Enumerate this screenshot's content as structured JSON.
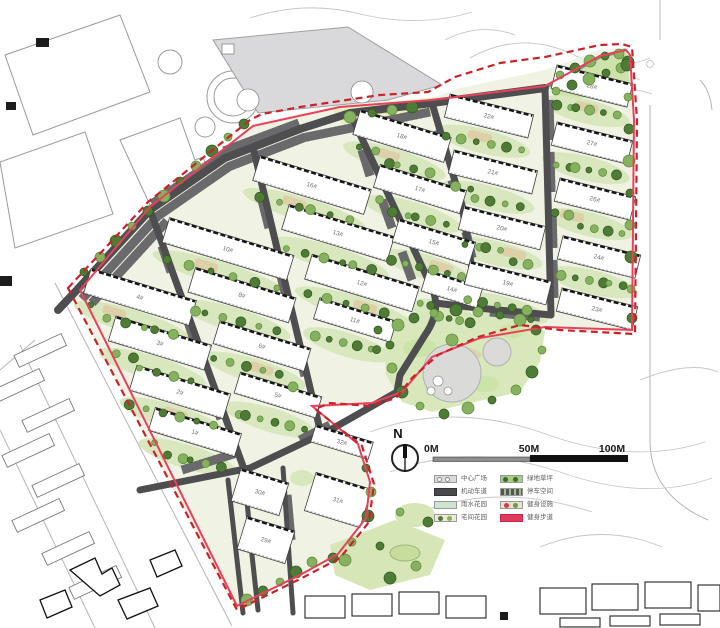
{
  "north_arrow": {
    "label": "N"
  },
  "scale_bar": {
    "labels": [
      "0M",
      "50M",
      "100M"
    ]
  },
  "legend": {
    "items": [
      {
        "label": "中心广场",
        "type": "plaza"
      },
      {
        "label": "机动车道",
        "type": "road"
      },
      {
        "label": "雨水花园",
        "type": "rain"
      },
      {
        "label": "宅间花园",
        "type": "courtyard"
      },
      {
        "label": "绿地草坪",
        "type": "lawn"
      },
      {
        "label": "停车空间",
        "type": "parking"
      },
      {
        "label": "健身设施",
        "type": "fitness"
      },
      {
        "label": "健身步道",
        "type": "trail"
      }
    ]
  },
  "map": {
    "colors": {
      "boundary": "#c8232b",
      "trail": "#e8415c",
      "road": "#4e4e50",
      "road_minor": "#87878a",
      "parking_base": "#6a6a6c",
      "parking_tick": "#a9c78e",
      "garden": "#d8e7bd",
      "lawn": "#cde4a9",
      "park": "#d8e8ba",
      "tree_dark": "#4e7c36",
      "tree_light": "#86b15e",
      "tan_path": "#dfcaa6",
      "site_base": "#f0f3e4",
      "plaza_gray": "#dadad8",
      "parking_lot_gray": "#d9d9db"
    },
    "buildings": [
      {
        "label": "4#",
        "cx": 140,
        "cy": 297,
        "w": 110,
        "h": 26,
        "angle": 17
      },
      {
        "label": "3#",
        "cx": 160,
        "cy": 343,
        "w": 100,
        "h": 26,
        "angle": 17
      },
      {
        "label": "2#",
        "cx": 180,
        "cy": 392,
        "w": 98,
        "h": 26,
        "angle": 17
      },
      {
        "label": "1#",
        "cx": 195,
        "cy": 432,
        "w": 90,
        "h": 24,
        "angle": 17
      },
      {
        "label": "10#",
        "cx": 228,
        "cy": 249,
        "w": 130,
        "h": 26,
        "angle": 17
      },
      {
        "label": "8#",
        "cx": 242,
        "cy": 295,
        "w": 105,
        "h": 26,
        "angle": 17
      },
      {
        "label": "6#",
        "cx": 262,
        "cy": 346,
        "w": 95,
        "h": 24,
        "angle": 17
      },
      {
        "label": "5#",
        "cx": 278,
        "cy": 395,
        "w": 85,
        "h": 22,
        "angle": 17
      },
      {
        "label": "16#",
        "cx": 312,
        "cy": 185,
        "w": 116,
        "h": 26,
        "angle": 17
      },
      {
        "label": "13#",
        "cx": 338,
        "cy": 233,
        "w": 110,
        "h": 26,
        "angle": 17
      },
      {
        "label": "12#",
        "cx": 362,
        "cy": 283,
        "w": 112,
        "h": 26,
        "angle": 17
      },
      {
        "label": "11#",
        "cx": 355,
        "cy": 320,
        "w": 80,
        "h": 22,
        "angle": 17
      },
      {
        "label": "18#",
        "cx": 402,
        "cy": 136,
        "w": 95,
        "h": 26,
        "angle": 17
      },
      {
        "label": "17#",
        "cx": 420,
        "cy": 189,
        "w": 90,
        "h": 24,
        "angle": 17
      },
      {
        "label": "15#",
        "cx": 434,
        "cy": 242,
        "w": 80,
        "h": 24,
        "angle": 17
      },
      {
        "label": "14#",
        "cx": 452,
        "cy": 289,
        "w": 58,
        "h": 22,
        "angle": 17
      },
      {
        "label": "22#",
        "cx": 489,
        "cy": 116,
        "w": 86,
        "h": 24,
        "angle": 14
      },
      {
        "label": "21#",
        "cx": 493,
        "cy": 172,
        "w": 86,
        "h": 24,
        "angle": 14
      },
      {
        "label": "20#",
        "cx": 502,
        "cy": 228,
        "w": 84,
        "h": 24,
        "angle": 14
      },
      {
        "label": "19#",
        "cx": 508,
        "cy": 283,
        "w": 84,
        "h": 24,
        "angle": 14
      },
      {
        "label": "28#",
        "cx": 592,
        "cy": 86,
        "w": 78,
        "h": 24,
        "angle": 14
      },
      {
        "label": "27#",
        "cx": 592,
        "cy": 143,
        "w": 78,
        "h": 24,
        "angle": 14
      },
      {
        "label": "26#",
        "cx": 595,
        "cy": 199,
        "w": 78,
        "h": 24,
        "angle": 14
      },
      {
        "label": "24#",
        "cx": 599,
        "cy": 257,
        "w": 80,
        "h": 24,
        "angle": 14
      },
      {
        "label": "23#",
        "cx": 597,
        "cy": 309,
        "w": 78,
        "h": 24,
        "angle": 14
      },
      {
        "label": "32#",
        "cx": 342,
        "cy": 442,
        "w": 60,
        "h": 18,
        "angle": 17
      },
      {
        "label": "30#",
        "cx": 260,
        "cy": 492,
        "w": 50,
        "h": 34,
        "angle": 17
      },
      {
        "label": "29#",
        "cx": 266,
        "cy": 540,
        "w": 50,
        "h": 34,
        "angle": 17
      },
      {
        "label": "31#",
        "cx": 338,
        "cy": 500,
        "w": 58,
        "h": 40,
        "angle": 17
      }
    ],
    "no_garden": [
      "30#",
      "29#",
      "31#",
      "32#",
      "23#"
    ],
    "extra_trees": [
      [
        84,
        272
      ],
      [
        100,
        257
      ],
      [
        116,
        241
      ],
      [
        132,
        226
      ],
      [
        148,
        211
      ],
      [
        164,
        196
      ],
      [
        180,
        181
      ],
      [
        196,
        166
      ],
      [
        212,
        151
      ],
      [
        228,
        137
      ],
      [
        244,
        124
      ],
      [
        350,
        117
      ],
      [
        372,
        113
      ],
      [
        392,
        110
      ],
      [
        412,
        107
      ],
      [
        560,
        75
      ],
      [
        575,
        68
      ],
      [
        590,
        61
      ],
      [
        605,
        56
      ],
      [
        619,
        54
      ],
      [
        628,
        62
      ],
      [
        556,
        91
      ],
      [
        572,
        85
      ],
      [
        589,
        79
      ],
      [
        606,
        73
      ],
      [
        621,
        68
      ],
      [
        627,
        65
      ],
      [
        628,
        97
      ],
      [
        629,
        129
      ],
      [
        629,
        161
      ],
      [
        630,
        193
      ],
      [
        630,
        225
      ],
      [
        631,
        257
      ],
      [
        631,
        289
      ],
      [
        632,
        318
      ],
      [
        398,
        325
      ],
      [
        390,
        345
      ],
      [
        392,
        368
      ],
      [
        402,
        392
      ],
      [
        420,
        406
      ],
      [
        444,
        414
      ],
      [
        468,
        408
      ],
      [
        492,
        400
      ],
      [
        516,
        390
      ],
      [
        532,
        372
      ],
      [
        542,
        350
      ],
      [
        536,
        330
      ],
      [
        520,
        320
      ],
      [
        500,
        315
      ],
      [
        478,
        312
      ],
      [
        456,
        310
      ],
      [
        434,
        313
      ],
      [
        414,
        318
      ],
      [
        452,
        340
      ],
      [
        378,
        330
      ],
      [
        312,
        562
      ],
      [
        296,
        572
      ],
      [
        280,
        582
      ],
      [
        263,
        591
      ],
      [
        247,
        600
      ],
      [
        366,
        468
      ],
      [
        371,
        492
      ],
      [
        368,
        516
      ],
      [
        352,
        542
      ],
      [
        333,
        558
      ],
      [
        345,
        560
      ],
      [
        380,
        546
      ],
      [
        416,
        566
      ],
      [
        390,
        578
      ],
      [
        400,
        512
      ],
      [
        428,
        522
      ]
    ]
  }
}
